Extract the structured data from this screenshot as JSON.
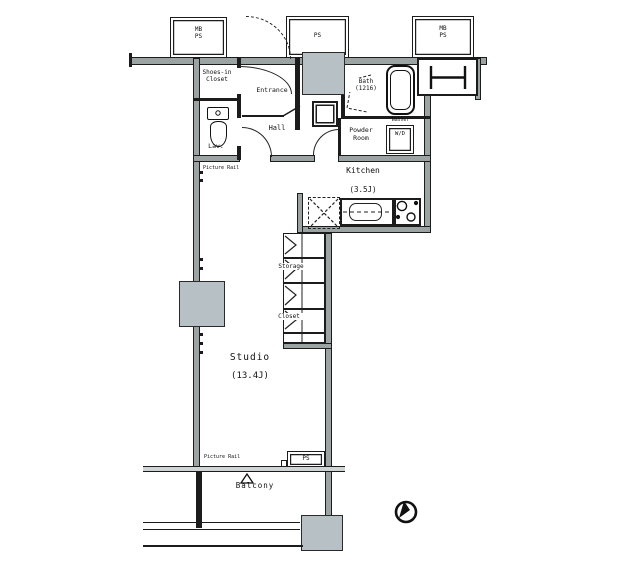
{
  "colors": {
    "background": "#ffffff",
    "wall_fill": "#9ba3a3",
    "shaft_fill": "#b6c0c5",
    "line": "#1c1c1c"
  },
  "labels": {
    "shafts": {
      "top_left_l1": "MB",
      "top_left_l2": "PS",
      "top_middle": "PS",
      "top_right_l1": "MB",
      "top_right_l2": "PS",
      "bottom_ps": "PS"
    },
    "rooms": {
      "shoes_closet_l1": "Shoes-in",
      "shoes_closet_l2": "Closet",
      "entrance": "Entrance",
      "lavatory": "Lav.",
      "hall": "Hall",
      "bath_l1": "Bath",
      "bath_l2": "(1216)",
      "powder_l1": "Powder",
      "powder_l2": "Room",
      "kitchen": "Kitchen",
      "kitchen_size": "(3.5J)",
      "storage": "Storage",
      "closet": "Closet",
      "studio": "Studio",
      "studio_size": "(13.4J)",
      "balcony": "Balcony"
    },
    "fixtures": {
      "washer_area": "Washer",
      "washer_dryer": "W/D"
    },
    "marks": {
      "picture_rail_top": "Picture Rail",
      "picture_rail_bottom": "Picture Rail"
    }
  }
}
